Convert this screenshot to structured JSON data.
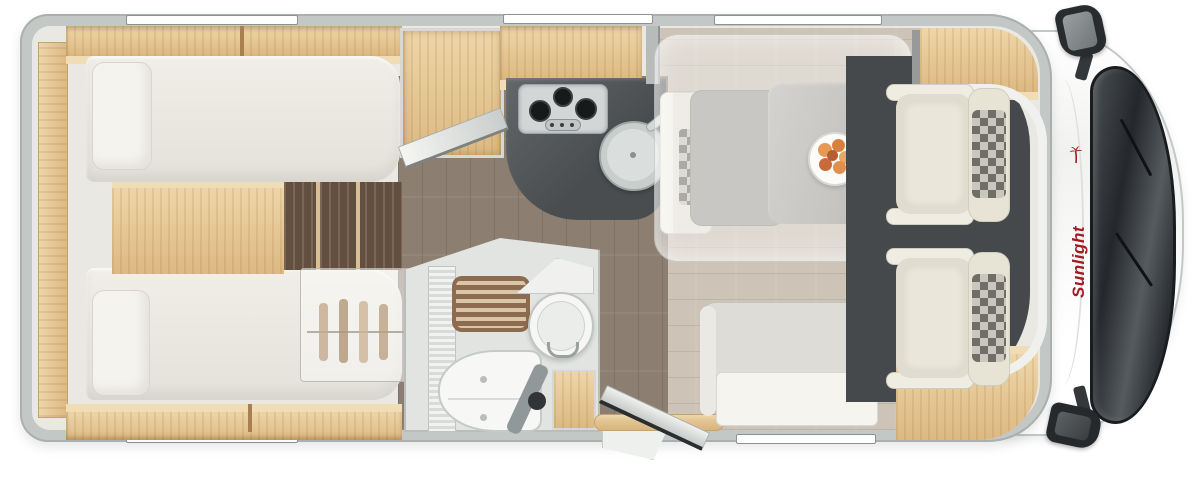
{
  "brand": {
    "logo_text": "Sunlight"
  },
  "colors": {
    "brand_red": "#a01d23",
    "wall_gray": "#c3c7c5",
    "oak_wood": "#e2c290",
    "dark_step_wood": "#6f5a48",
    "corridor_floor": "#8c7f71",
    "dinette_floor": "#cdc3b6",
    "kitchen_counter": "#54585a",
    "cab_glass": "#2b2f32",
    "upholstery_cream": "#e9e6d9"
  },
  "icons": {
    "palm_tree_icon": "red stylized palm (brand mark)",
    "side_mirror_top_icon": "css-shape",
    "side_mirror_bottom_icon": "css-shape"
  }
}
